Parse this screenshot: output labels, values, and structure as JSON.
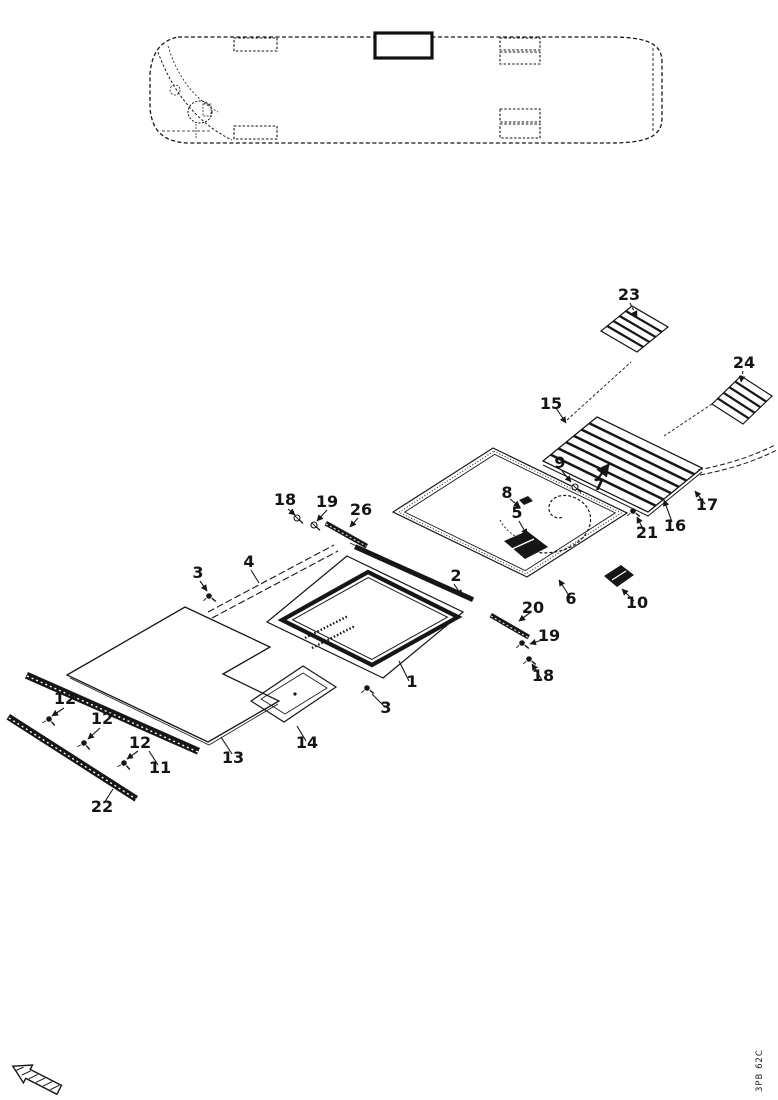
{
  "page": {
    "doc_code": "3PB 62C"
  },
  "callouts": {
    "n23": "23",
    "n24": "24",
    "n15": "15",
    "n18a": "18",
    "n19a": "19",
    "n26": "26",
    "n3a": "3",
    "n4": "4",
    "n2": "2",
    "n9": "9",
    "n7": "7",
    "n8": "8",
    "n5": "5",
    "n21": "21",
    "n16": "16",
    "n17": "17",
    "n6": "6",
    "n10": "10",
    "n20": "20",
    "n19b": "19",
    "n18b": "18",
    "n1": "1",
    "n3b": "3",
    "n12a": "12",
    "n12b": "12",
    "n12c": "12",
    "n11": "11",
    "n13": "13",
    "n14": "14",
    "n22": "22"
  }
}
